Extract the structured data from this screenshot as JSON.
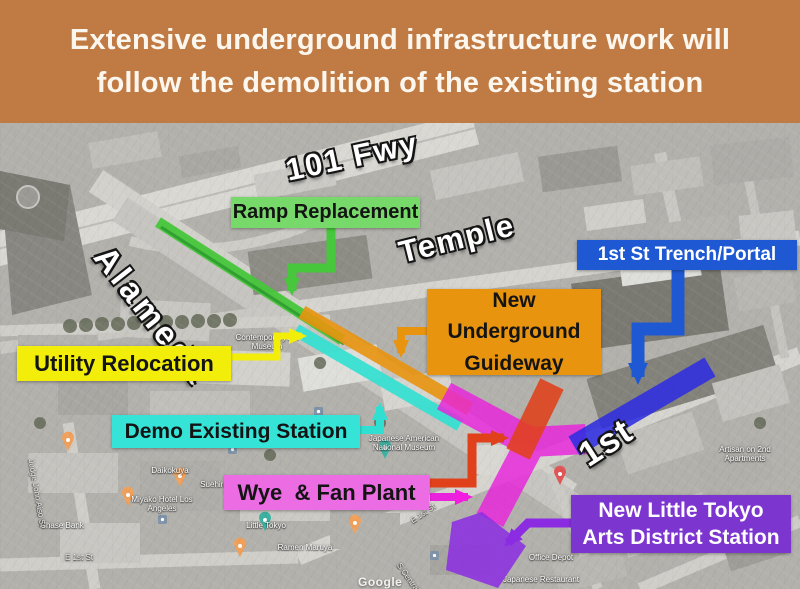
{
  "title": {
    "line1": "Extensive underground infrastructure work will",
    "line2": "follow the demolition of the existing station"
  },
  "colors": {
    "banner_bg": "#c07b45",
    "green": "#47c73b",
    "green_dark": "#2b9e2b",
    "green_box": "#76d96a",
    "yellow": "#f2ee0a",
    "cyan": "#2fe0d2",
    "cyan_box": "#35e3d7",
    "orange": "#e8940e",
    "blue": "#1e59d3",
    "blue_strip": "#2f2de0",
    "red": "#e0401a",
    "magenta": "#e923dc",
    "magenta_box": "#ec6ce4",
    "purple": "#8b2ce2",
    "purple_box": "#7d35d0"
  },
  "map": {
    "street_labels": [
      {
        "text": "101 Fwy"
      },
      {
        "text": "Alameda"
      },
      {
        "text": "Temple"
      },
      {
        "text": "1st"
      }
    ],
    "callouts": [
      {
        "text": "Ramp Replacement"
      },
      {
        "text": "Utility Relocation"
      },
      {
        "text": "Demo Existing Station"
      },
      {
        "text": "New Underground Guideway"
      },
      {
        "text": "1st St Trench/Portal"
      },
      {
        "text": "Wye  & Fan Plant"
      },
      {
        "text": "New Little Tokyo Arts District Station"
      }
    ],
    "poi_labels": [
      {
        "text": "Japanese American National Museum"
      },
      {
        "text": "Daikokuya"
      },
      {
        "text": "Suehiro"
      },
      {
        "text": "Miyako Hotel Los Angeles"
      },
      {
        "text": "Little Tokyo"
      },
      {
        "text": "Ramen Maruya"
      },
      {
        "text": "Chase Bank"
      },
      {
        "text": "E 1st St"
      },
      {
        "text": "E 1st St"
      },
      {
        "text": "Office Depot"
      },
      {
        "text": "Japanese Restaurant"
      },
      {
        "text": "Artisan on 2nd Apartments"
      },
      {
        "text": "Judge John Aiso St"
      },
      {
        "text": "S Central Ave"
      },
      {
        "text": "Contemporary Art Museum"
      }
    ],
    "watermark": "Google"
  }
}
